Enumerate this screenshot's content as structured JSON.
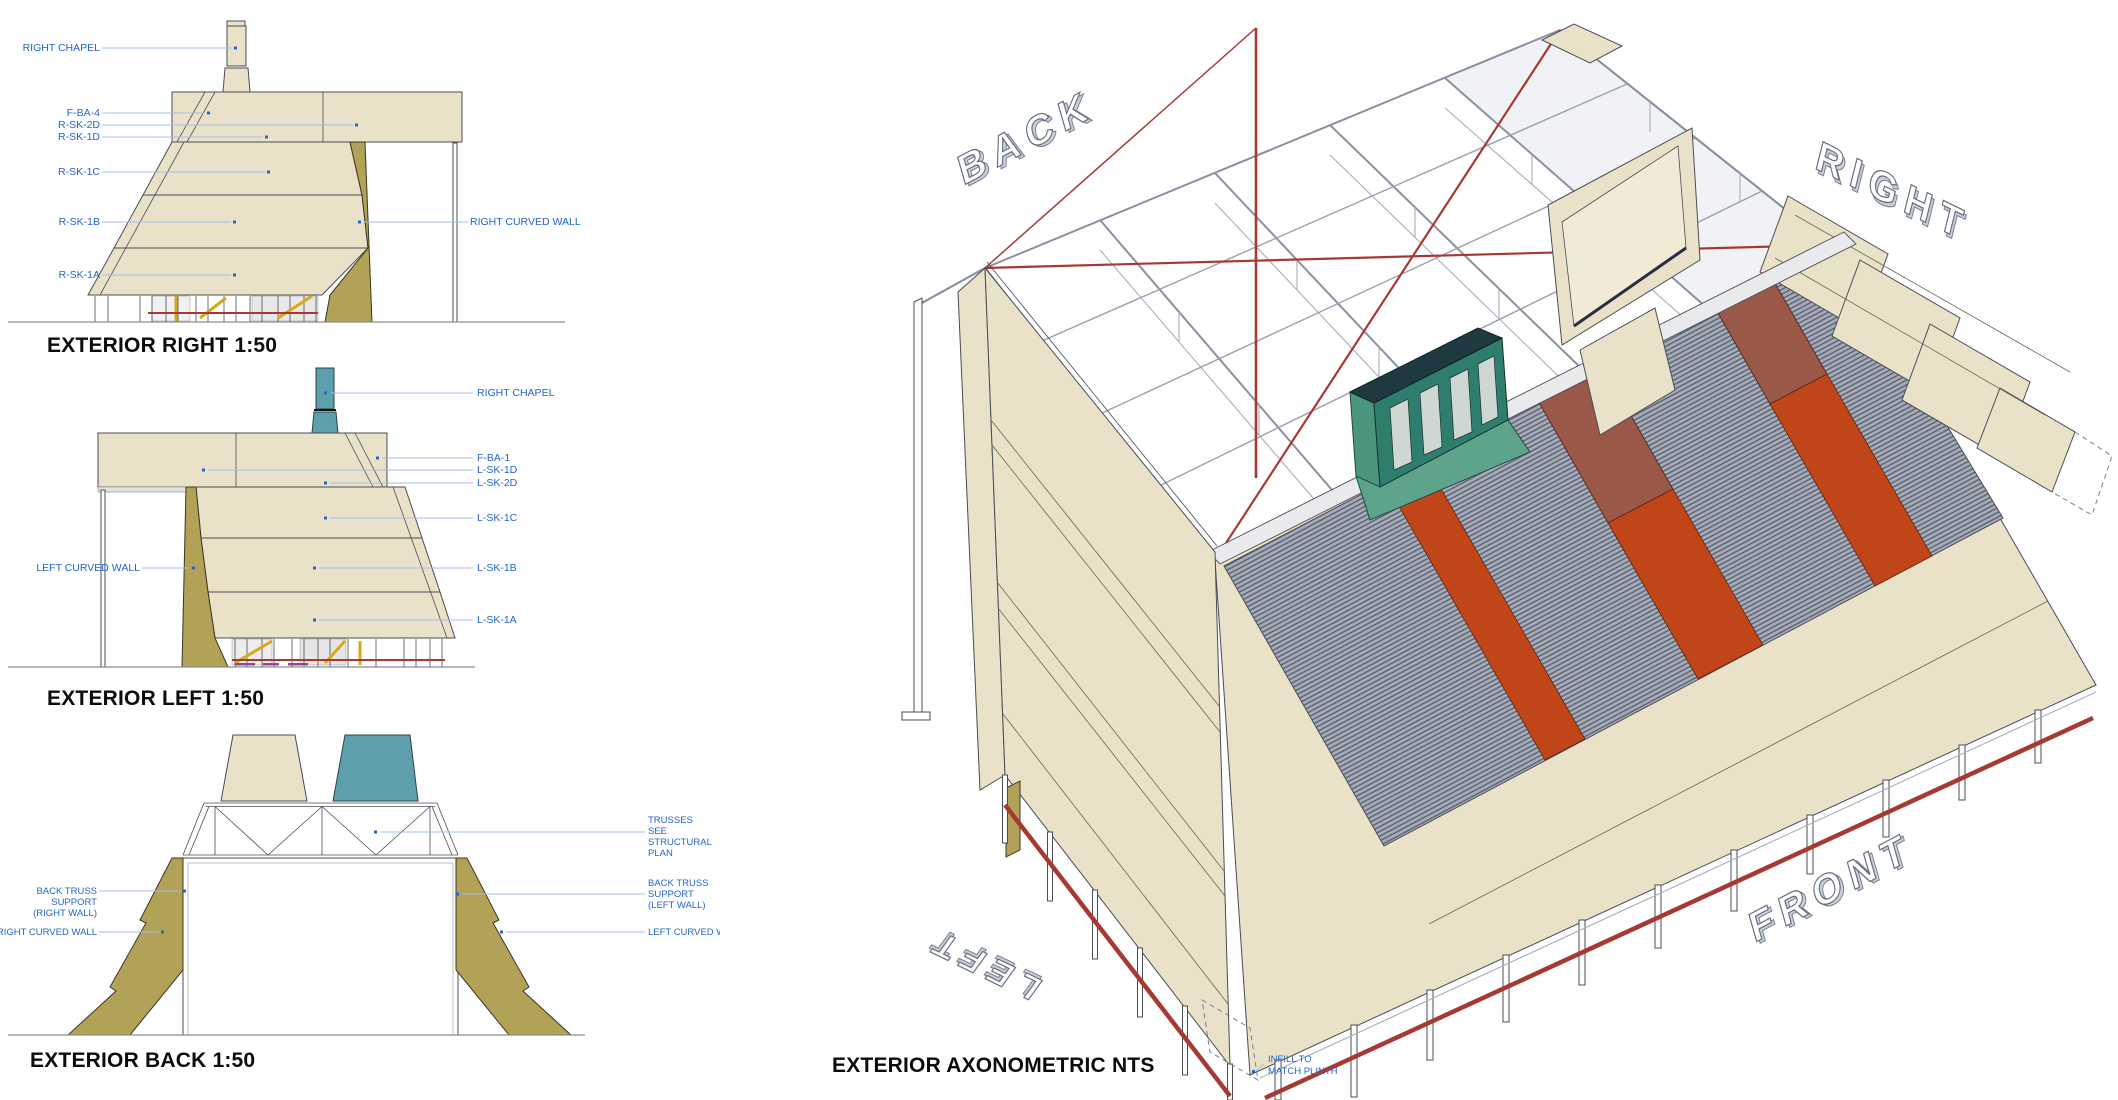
{
  "colors": {
    "label_blue": "#2565CB",
    "leader_blue": "#A6BCE8",
    "title_black": "#0C0C0C",
    "cream_wall": "#EAE2C8",
    "khaki_curved_wall": "#B2A257",
    "teal_chapel": "#5E9FAD",
    "teal_chapel_axon": "#2F7D6D",
    "roof_screen_gray": "#A6ACB9",
    "roof_screen_stripe": "#5A5F6C",
    "rust_orange": "#C0461A",
    "rust_brown": "#9A5848",
    "brace_red": "#A63A32",
    "steel_gray": "#CDD1D9",
    "yellow_strut": "#D8A818",
    "purple_mark": "#8A4A9A"
  },
  "views": {
    "exterior_right": {
      "title": "EXTERIOR RIGHT 1:50",
      "labels": {
        "right_chapel": "RIGHT CHAPEL",
        "f_ba_4": "F-BA-4",
        "r_sk_2d": "R-SK-2D",
        "r_sk_1d": "R-SK-1D",
        "r_sk_1c": "R-SK-1C",
        "r_sk_1b": "R-SK-1B",
        "r_sk_1a": "R-SK-1A",
        "right_curved_wall": "RIGHT CURVED WALL"
      }
    },
    "exterior_left": {
      "title": "EXTERIOR LEFT 1:50",
      "labels": {
        "right_chapel": "RIGHT CHAPEL",
        "f_ba_1": "F-BA-1",
        "l_sk_1d": "L-SK-1D",
        "l_sk_2d": "L-SK-2D",
        "l_sk_1c": "L-SK-1C",
        "l_sk_1b": "L-SK-1B",
        "l_sk_1a": "L-SK-1A",
        "left_curved_wall": "LEFT CURVED WALL"
      }
    },
    "exterior_back": {
      "title": "EXTERIOR BACK 1:50",
      "labels": {
        "trusses": [
          "TRUSSES",
          "SEE",
          "STRUCTURAL",
          "PLAN"
        ],
        "back_truss_support_right": [
          "BACK TRUSS",
          "SUPPORT",
          "(RIGHT WALL)"
        ],
        "right_curved_wall": "RIGHT CURVED WALL",
        "back_truss_support_left": [
          "BACK TRUSS",
          "SUPPORT",
          "(LEFT WALL)"
        ],
        "left_curved_wall": "LEFT CURVED WALL"
      }
    },
    "exterior_axonometric": {
      "title": "EXTERIOR AXONOMETRIC NTS",
      "labels": {
        "back": "BACK",
        "right": "RIGHT",
        "left": "LEFT",
        "front": "FRONT",
        "infill": [
          "INFILL TO",
          "MATCH PLINTH"
        ]
      }
    }
  }
}
